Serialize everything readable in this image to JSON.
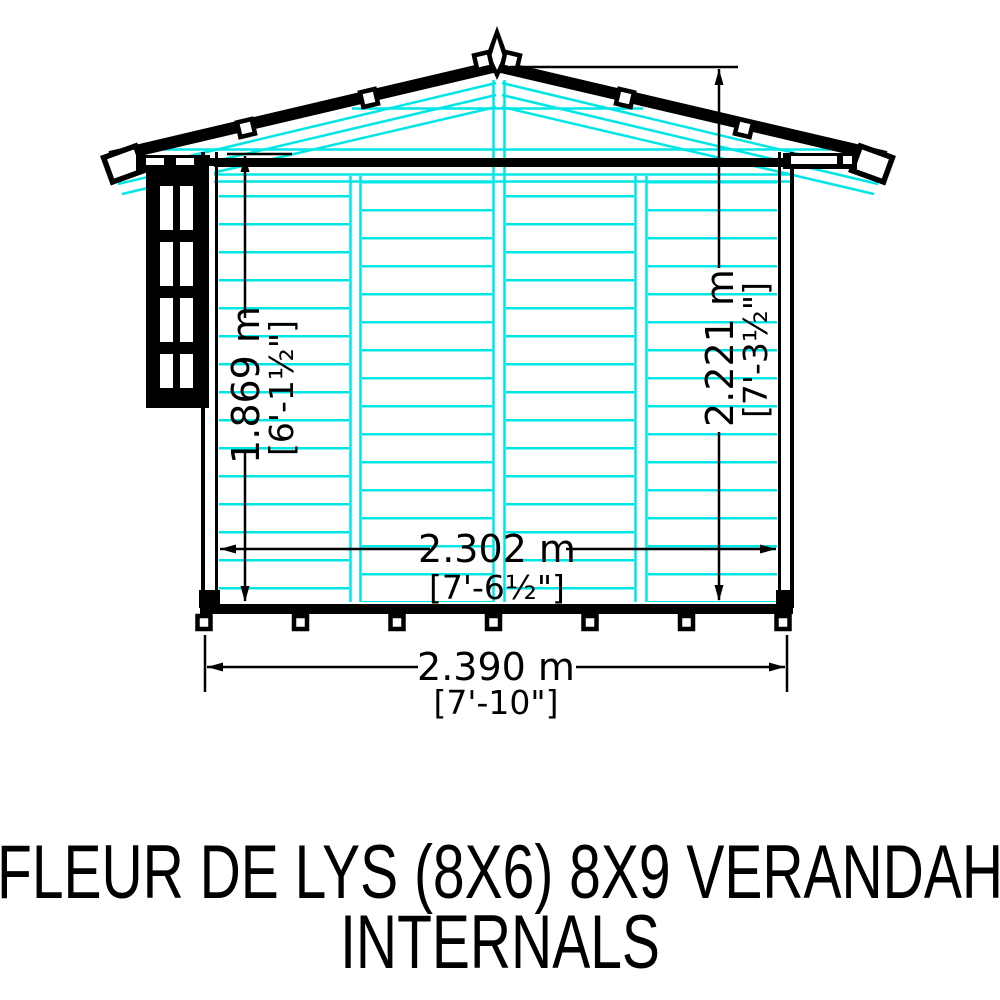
{
  "title": {
    "line1": "FLEUR DE LYS (8X6) 8X9 VERANDAH",
    "line2": "INTERNALS"
  },
  "dimensions": {
    "eaves_height": {
      "metric": "1.869 m",
      "imperial": "[6'-1½\"]"
    },
    "ridge_height": {
      "metric": "2.221 m",
      "imperial": "[7'-3½\"]"
    },
    "internal_width": {
      "metric": "2.302 m",
      "imperial": "[7'-6½\"]"
    },
    "external_width": {
      "metric": "2.390 m",
      "imperial": "[7'-10\"]"
    }
  },
  "colors": {
    "cladding": "#00e6e6",
    "outline": "#000000",
    "background": "#ffffff"
  }
}
